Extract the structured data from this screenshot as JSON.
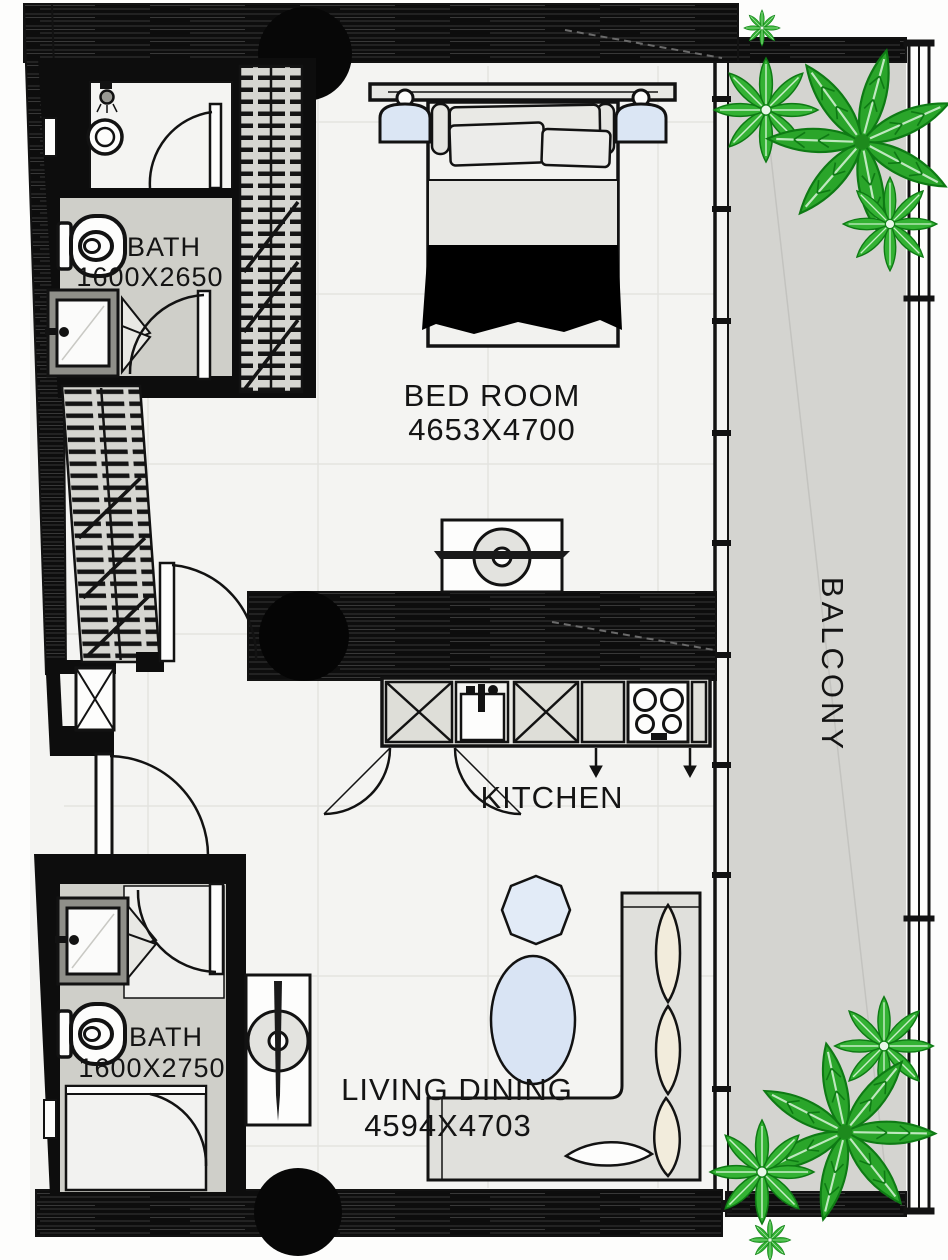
{
  "floorplan": {
    "title": "apartment-unit-floor-plan",
    "rooms": {
      "bath_top": {
        "name": "BATH",
        "dims": "1600X2650"
      },
      "bedroom": {
        "name": "BED ROOM",
        "dims": "4653X4700"
      },
      "kitchen": {
        "name": "KITCHEN"
      },
      "balcony": {
        "name": "BALCONY"
      },
      "bath_bottom": {
        "name": "BATH",
        "dims": "1600X2750"
      },
      "living": {
        "name": "LIVING DINING",
        "dims": "4594X4703"
      }
    },
    "colors": {
      "wall": "#0d0d0d",
      "floor": "#f4f4f2",
      "bath_floor": "#cfcfc9",
      "balcony_floor": "#d4d4d0",
      "plant_green": "#2aa52a",
      "accent_blue": "#dbe6f4",
      "cushion_cream": "#f2ecdc"
    }
  }
}
